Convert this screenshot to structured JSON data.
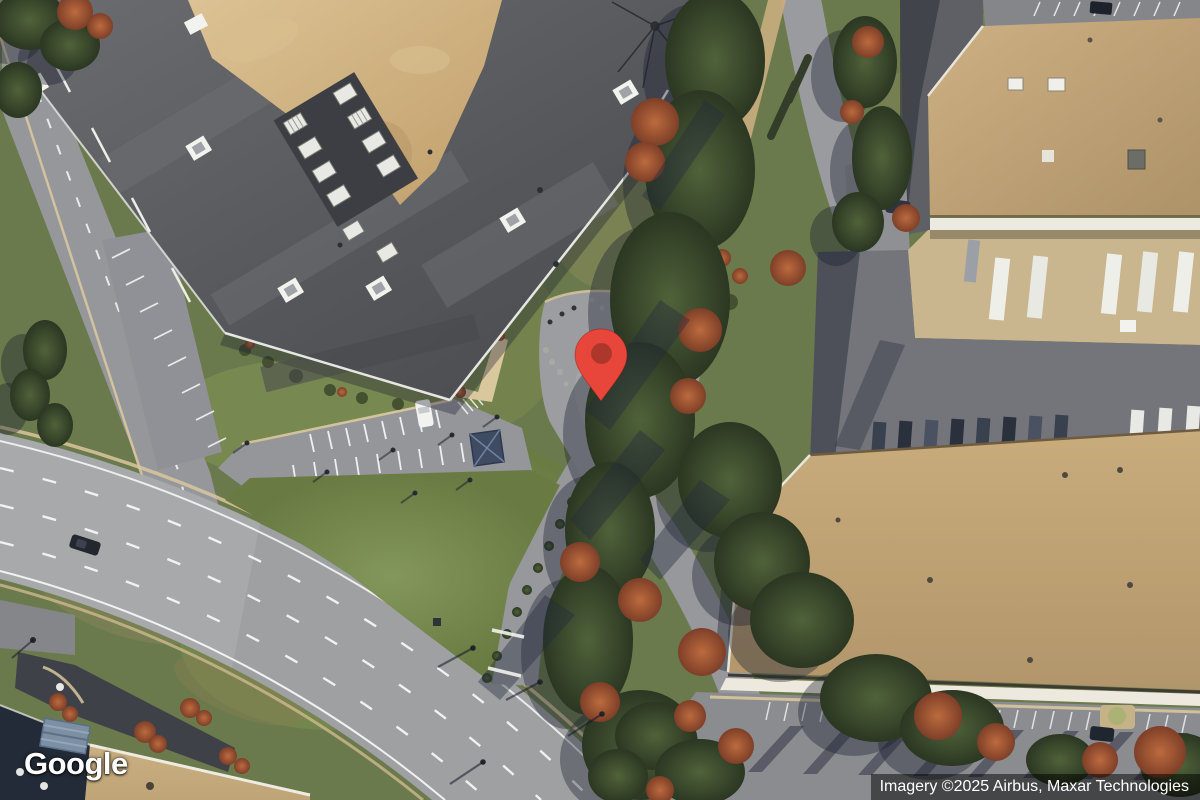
{
  "map": {
    "view_type": "satellite",
    "logo_text": "Google",
    "attribution_text": "Imagery ©2025 Airbus, Maxar Technologies",
    "marker": {
      "x": 601,
      "y": 402,
      "pin_color": "#E8463A",
      "pin_dot_color": "#AE372B"
    }
  },
  "palette": {
    "grass": "#6B7A4C",
    "grass_bright": "#7E9055",
    "road_asphalt": "#9EA0A2",
    "roof_dark": "#55565A",
    "roof_tan": "#BFA379",
    "dirt": "#CBA878",
    "tree_green": "#3A4A2E",
    "tree_autumn": "#A14F30",
    "concrete": "#C9B68E"
  }
}
